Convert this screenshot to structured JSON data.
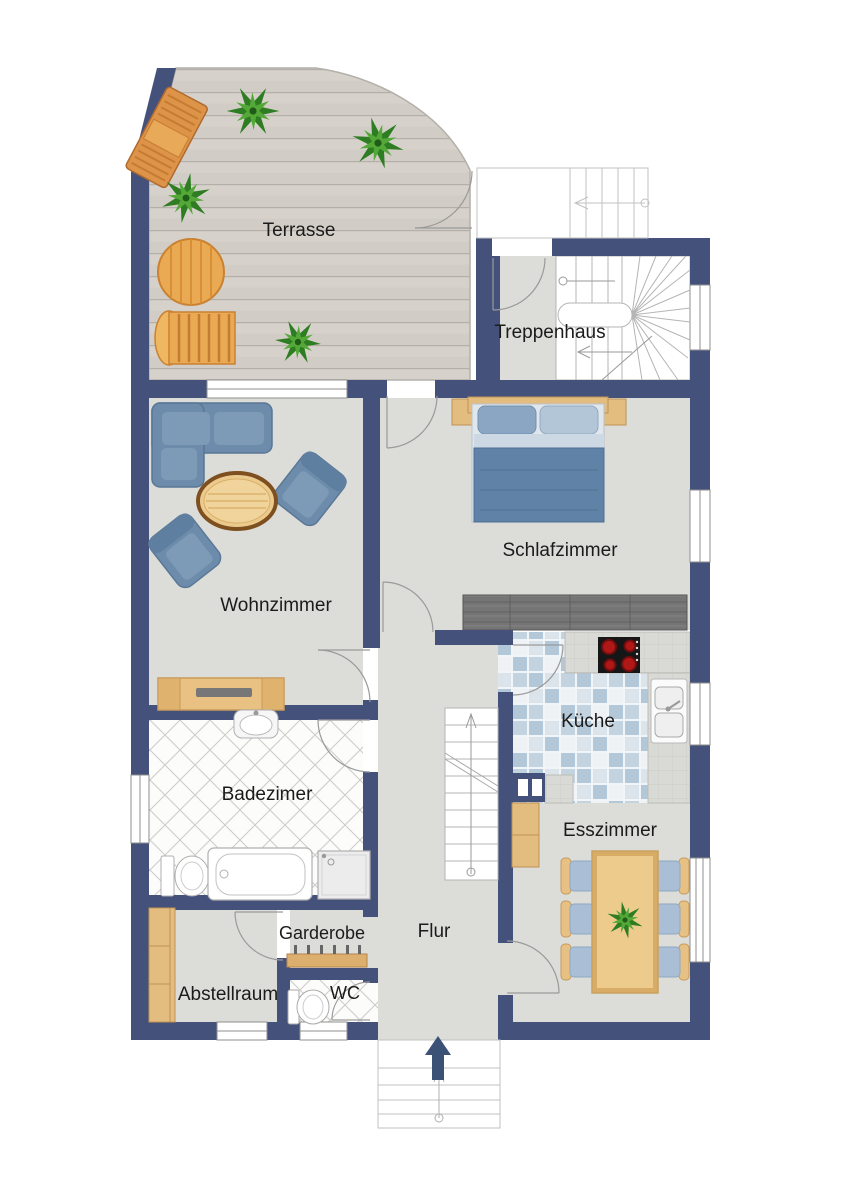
{
  "rooms": {
    "terrasse": {
      "label": "Terrasse"
    },
    "treppenhaus": {
      "label": "Treppenhaus"
    },
    "wohnzimmer": {
      "label": "Wohnzimmer"
    },
    "schlafzimmer": {
      "label": "Schlafzimmer"
    },
    "kueche": {
      "label": "Küche"
    },
    "esszimmer": {
      "label": "Esszimmer"
    },
    "badezimer": {
      "label": "Badezimer"
    },
    "flur": {
      "label": "Flur"
    },
    "garderobe": {
      "label": "Garderobe"
    },
    "wc": {
      "label": "WC"
    },
    "abstellraum": {
      "label": "Abstellraum"
    }
  },
  "colors": {
    "wall": "#44517a",
    "floor": "#dcdcd9",
    "deck_wood": "#d6d2cb",
    "bath_tile_line": "#cbcbc8",
    "kitchen_tile_blue": "#b2c7d8",
    "counter": "#d9d9d5",
    "wood_furniture": "#e6c183",
    "upholstery_blue": "#6d8cab",
    "bed_duvet": "#5f82a6",
    "dark_wardrobe": "#757575",
    "stove_burner_red": "#b01818",
    "plant_green": "#2e7d22",
    "entrance_arrow": "#3c5176",
    "label_text": "#1b1b1b"
  }
}
